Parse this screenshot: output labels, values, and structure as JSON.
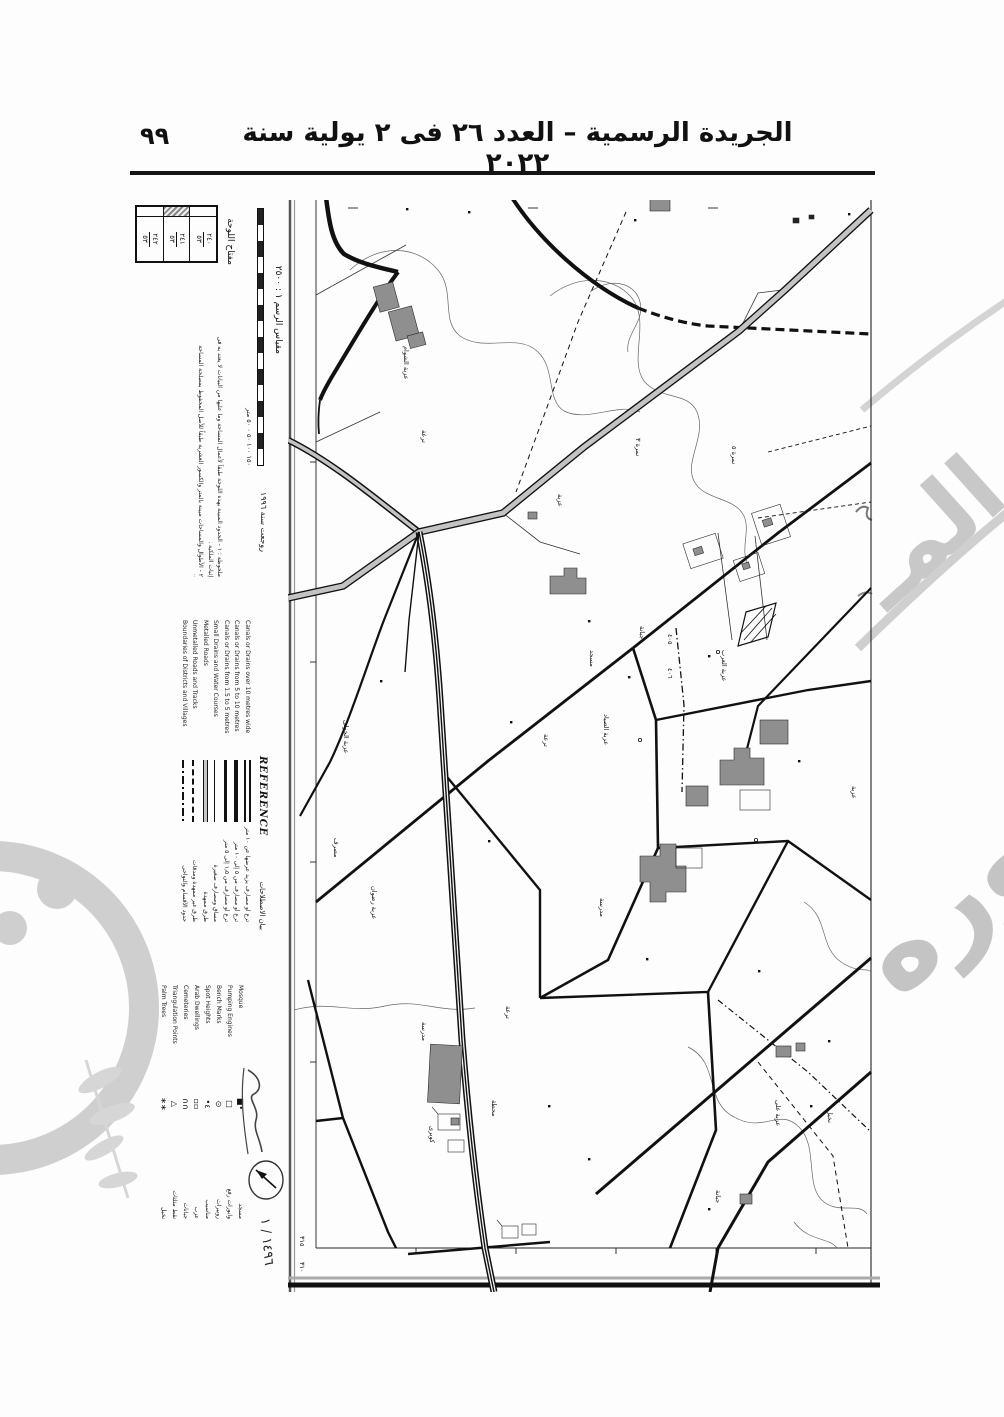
{
  "page": {
    "title": "الجريدة الرسمية – العدد ٢٦ فى ٢ يولية سنة ٢٠٢٢",
    "page_number": "٩٩"
  },
  "colors": {
    "ink": "#151515",
    "road_fill": "#c3c3c3",
    "building_fill": "#8f8f8f",
    "watermark": "#c9c9c9",
    "paper": "#fdfdfd"
  },
  "marginalia": {
    "sheet_no": "١٤٩٦ / ١",
    "key_table": {
      "label": "مفتاح اللوحة",
      "cells": [
        {
          "top": "٢٤٠",
          "bottom": "٥٣"
        },
        {
          "top": "٢٤١",
          "bottom": "٥٣"
        },
        {
          "top": "٢٤٢",
          "bottom": "٥٣"
        }
      ]
    },
    "scale": {
      "caption": "مقياس الرسم ١ : ٢٥٠٠",
      "ticks": "١٥٠ ١٠٠ ٥٠ ٠ ٥٠ متر",
      "revision": "روجعت سنة ١٩٩٦"
    },
    "notes": {
      "line1": "ملحوظة : ١ - الحدود المبينة بهذه اللوحة طبقاً لأعمال المساحة وما عليها من البيانات لا يعتد به فى إثبات الملكية .",
      "line2": "٢ - الأطوال والمساحات مبينة بالمتر والكسور العشرية طبقاً للأصل المحفوظ بمصلحة المساحة المصرية ."
    },
    "reference": {
      "title": "REFERENCE",
      "subtitle": "بيان الاصطلاحات",
      "entries": [
        {
          "en": "Canals or Drains over 10 metres wide",
          "ar": "ترع أو مصارف يزيد عرضها عن ١٠ متر"
        },
        {
          "en": "Canals or Drains from 5 to 10 metres",
          "ar": "ترع أو مصارف من ٥ إلى ١٠ متر"
        },
        {
          "en": "Canals or Drains from 1.5 to 5 metres",
          "ar": "ترع أو مصارف من ١٫٥ إلى ٥ متر"
        },
        {
          "en": "Small Drains and Water Courses",
          "ar": "مساقٍ ومصارف صغيرة"
        },
        {
          "en": "Metalled Roads",
          "ar": "طرق ممهدة"
        },
        {
          "en": "Unmetalled Roads and Tracks",
          "ar": "طرق غير ممهدة ومدقات"
        },
        {
          "en": "Boundaries of Districts and Villages",
          "ar": "حدود الأقسام والنواحى"
        }
      ]
    },
    "legend2": {
      "entries": [
        {
          "en": "Mosque",
          "ar": "مسجد",
          "glyph": "■•"
        },
        {
          "en": "Pumping Engines",
          "ar": "وابورات رفع",
          "glyph": "□"
        },
        {
          "en": "Bench Marks",
          "ar": "روبيرات",
          "glyph": "⊙"
        },
        {
          "en": "Spot Heights",
          "ar": "مناسيب",
          "glyph": "•٤"
        },
        {
          "en": "Arab Dwellings",
          "ar": "عزب",
          "glyph": "▫▫"
        },
        {
          "en": "Cemeteries",
          "ar": "جبانات",
          "glyph": "∩∩"
        },
        {
          "en": "Triangulation Points",
          "ar": "نقط مثلثات",
          "glyph": "△"
        },
        {
          "en": "Palm Trees",
          "ar": "نخيل",
          "glyph": "∗∗"
        }
      ]
    }
  },
  "map": {
    "labels": [
      {
        "text": "عزبة الشوام"
      },
      {
        "text": "ترعة"
      },
      {
        "text": "عزبة الخولى"
      },
      {
        "text": "مصرف"
      },
      {
        "text": "عزبة رضوان"
      },
      {
        "text": "عزبة"
      },
      {
        "text": "نمرة ٣"
      },
      {
        "text": "جبانة"
      },
      {
        "text": "مسجد"
      },
      {
        "text": "عزبة الصياد"
      },
      {
        "text": "ترعة"
      },
      {
        "text": "عزبة العرب"
      },
      {
        "text": "نمرة ٥"
      },
      {
        "text": "مدرسة"
      },
      {
        "text": "ترعة"
      },
      {
        "text": "مدرسة"
      },
      {
        "text": "محطة"
      },
      {
        "text": "عزبة على"
      },
      {
        "text": "جبانة"
      },
      {
        "text": "كوبرى"
      },
      {
        "text": "عزبة"
      },
      {
        "text": "نخيل"
      },
      {
        "text": "٤٠٥"
      },
      {
        "text": "٤٠٦"
      },
      {
        "text": "٣١٥"
      },
      {
        "text": "٣١٠"
      }
    ]
  }
}
